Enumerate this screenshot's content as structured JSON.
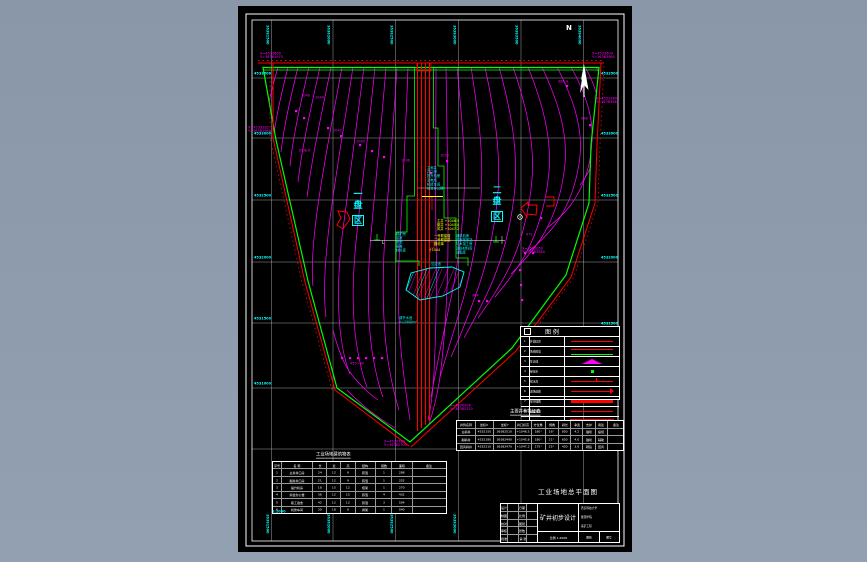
{
  "meta": {
    "description": "CAD mine industrial-site general layout drawing on black model space",
    "colors": {
      "background": "#8e9cae",
      "paper": "#000000",
      "frame": "#ffffff",
      "contour": "#ff00ff",
      "boundary_green": "#00ff00",
      "boundary_red": "#ff0000",
      "annotation_cyan": "#00ffff",
      "annotation_yellow": "#ffff00"
    }
  },
  "frame": {
    "north_letter": "N"
  },
  "grid": {
    "left_row_labels": [
      {
        "x": 254,
        "y": 72,
        "t": "4533500"
      },
      {
        "x": 254,
        "y": 132,
        "t": "4533000"
      },
      {
        "x": 254,
        "y": 194,
        "t": "4532500"
      },
      {
        "x": 254,
        "y": 256,
        "t": "4532000"
      },
      {
        "x": 254,
        "y": 317,
        "t": "4531500"
      },
      {
        "x": 254,
        "y": 382,
        "t": "4531000"
      }
    ],
    "right_row_labels": [
      {
        "x": 601,
        "y": 72,
        "t": "4533500"
      },
      {
        "x": 601,
        "y": 132,
        "t": "4533000"
      },
      {
        "x": 601,
        "y": 194,
        "t": "4532500"
      },
      {
        "x": 601,
        "y": 256,
        "t": "4532000"
      },
      {
        "x": 601,
        "y": 322,
        "t": "4531500"
      },
      {
        "x": 601,
        "y": 382,
        "t": "4531000"
      },
      {
        "x": 601,
        "y": 444,
        "t": "4530500"
      }
    ],
    "top_col_labels": [
      {
        "x": 269,
        "y": 25,
        "t": "36381500",
        "r": 1
      },
      {
        "x": 330,
        "y": 25,
        "t": "36382000",
        "r": 1
      },
      {
        "x": 393,
        "y": 25,
        "t": "36382500",
        "r": 1
      },
      {
        "x": 456,
        "y": 25,
        "t": "36383000",
        "r": 1
      },
      {
        "x": 518,
        "y": 25,
        "t": "36383500",
        "r": 1
      },
      {
        "x": 581,
        "y": 25,
        "t": "36384000",
        "r": 1
      }
    ],
    "bottom_col_labels": [
      {
        "x": 269,
        "y": 514,
        "t": "36381500",
        "r": 1
      },
      {
        "x": 330,
        "y": 514,
        "t": "36382000",
        "r": 1
      },
      {
        "x": 393,
        "y": 514,
        "t": "36382500",
        "r": 1
      },
      {
        "x": 456,
        "y": 514,
        "t": "36383000",
        "r": 1
      }
    ]
  },
  "coord_labels": [
    {
      "x": 248,
      "y": 126,
      "t": "X=4533282",
      "t2": "Y=36381960"
    },
    {
      "x": 260,
      "y": 52,
      "t": "X=4533600",
      "t2": "Y=36381975"
    },
    {
      "x": 592,
      "y": 52,
      "t": "X=4533600",
      "t2": "Y=36383980"
    },
    {
      "x": 596,
      "y": 97,
      "t": "X=4533380",
      "t2": "Y=36383940"
    },
    {
      "x": 450,
      "y": 404,
      "t": "X=4530900",
      "t2": "Y=36383120"
    },
    {
      "x": 384,
      "y": 440,
      "t": "X=4530780",
      "t2": "Y=36382700"
    },
    {
      "x": 522,
      "y": 247,
      "t": "X=4532050",
      "t2": "Y=36383560"
    }
  ],
  "elev_labels": [
    {
      "x": 301,
      "y": 94,
      "t": "1046"
    },
    {
      "x": 315,
      "y": 96,
      "t": "1044"
    },
    {
      "x": 333,
      "y": 129,
      "t": "1042"
    },
    {
      "x": 356,
      "y": 140,
      "t": "1040"
    },
    {
      "x": 558,
      "y": 80,
      "t": "986.4"
    },
    {
      "x": 581,
      "y": 117,
      "t": "988"
    },
    {
      "x": 472,
      "y": 294,
      "t": "964"
    },
    {
      "x": 350,
      "y": 362,
      "t": "455+60"
    },
    {
      "x": 440,
      "y": 154,
      "t": "1038"
    },
    {
      "x": 526,
      "y": 233,
      "t": "972"
    },
    {
      "x": 298,
      "y": 149,
      "t": "1038.6"
    },
    {
      "x": 401,
      "y": 159,
      "t": "1036"
    }
  ],
  "clusters": {
    "top": {
      "x": 427,
      "y": 166,
      "lines": [
        "主斜井",
        "井口房",
        "提升机房",
        "变电所",
        "机修车间",
        "综合办公楼"
      ]
    },
    "left": {
      "x": 396,
      "y": 232,
      "lines": [
        "锅炉房",
        "浴室",
        "食堂",
        "宿舍",
        "材料库"
      ]
    },
    "right": {
      "x": 456,
      "y": 234,
      "lines": [
        "通风机房",
        "瓦斯抽放站",
        "坑木加工房",
        "消防材料库",
        "油脂库"
      ]
    },
    "pond": {
      "x": 399,
      "y": 316,
      "lines": [
        "调节水池",
        "V=2000m³"
      ]
    },
    "pond2": {
      "x": 431,
      "y": 262,
      "lines": [
        "沉淀池"
      ]
    }
  },
  "yellow_notes": {
    "a": {
      "x": 437,
      "y": 219,
      "lines": [
        "主井 +1046.5",
        "副井 +1045.0",
        "风井 +1047.2"
      ]
    },
    "b": {
      "x": 434,
      "y": 234,
      "lines": [
        "一号联建楼",
        "二号联建楼",
        "器材库"
      ]
    },
    "c": {
      "x": 429,
      "y": 248,
      "lines": [
        "+1044"
      ]
    }
  },
  "panels": {
    "left": {
      "chars": [
        "一",
        "盘",
        "区"
      ]
    },
    "right": {
      "chars": [
        "二",
        "盘",
        "区"
      ]
    }
  },
  "legend": {
    "title": "图    例",
    "rows": [
      {
        "n": "1",
        "name": "井田境界",
        "sym": "red-line"
      },
      {
        "n": "2",
        "name": "场地围墙",
        "sym": "red-green"
      },
      {
        "n": "3",
        "name": "等高线",
        "sym": "tent"
      },
      {
        "n": "4",
        "name": "绿化带",
        "sym": "green-dot"
      },
      {
        "n": "5",
        "name": "排水沟",
        "sym": "red-tick"
      },
      {
        "n": "6",
        "name": "进场道路",
        "sym": "red-arrow"
      },
      {
        "n": "7",
        "name": "架空线路",
        "sym": "red-line2"
      },
      {
        "n": "8",
        "name": "运煤通道",
        "sym": "red-line"
      },
      {
        "n": "9",
        "name": "工业广场",
        "sym": "mag-fill"
      },
      {
        "n": "10",
        "name": "其 它",
        "sym": "none"
      }
    ]
  },
  "tables": {
    "left": {
      "title": "工业场地建筑物表",
      "cols": "5 18 8 8 8 12 9 12 20",
      "rows": [
        [
          "序号",
          "名 称",
          "长",
          "宽",
          "高",
          "结构",
          "层数",
          "面积",
          "备注"
        ],
        [
          "1",
          "主井井口房",
          "24",
          "12",
          "9",
          "砖混",
          "1",
          "288",
          ""
        ],
        [
          "2",
          "副井井口房",
          "21",
          "12",
          "9",
          "砖混",
          "1",
          "252",
          ""
        ],
        [
          "3",
          "提升机房",
          "18",
          "15",
          "12",
          "框架",
          "1",
          "270",
          ""
        ],
        [
          "4",
          "综合办公楼",
          "36",
          "12",
          "15",
          "砖混",
          "4",
          "432",
          ""
        ],
        [
          "5",
          "职工宿舍",
          "42",
          "12",
          "12",
          "砖混",
          "3",
          "504",
          ""
        ],
        [
          "6",
          "机修车间",
          "30",
          "18",
          "9",
          "排架",
          "1",
          "540",
          ""
        ]
      ]
    },
    "right": {
      "title": "主要井巷特征表",
      "cols": "12 12 14 10 9 8 8 7 8 8 10",
      "rows": [
        [
          "井筒名称",
          "坐标X",
          "坐标Y",
          "井口标高",
          "方位角",
          "倾角",
          "斜长",
          "净宽",
          "支护",
          "用途",
          "备注"
        ],
        [
          "主斜井",
          "4532150",
          "36382510",
          "+1046.5",
          "180°",
          "16°",
          "850",
          "4.2",
          "锚喷",
          "提煤",
          ""
        ],
        [
          "副斜井",
          "4532180",
          "36382490",
          "+1045.8",
          "180°",
          "21°",
          "650",
          "4.0",
          "锚喷",
          "辅助",
          ""
        ],
        [
          "回风斜井",
          "4532210",
          "36382470",
          "+1047.2",
          "175°",
          "25°",
          "420",
          "3.6",
          "砌碹",
          "回风",
          ""
        ]
      ]
    }
  },
  "title_block": {
    "sig": {
      "cols": "10 16 10 16",
      "rows": [
        [
          "设计",
          "",
          "日期",
          ""
        ],
        [
          "制图",
          "",
          "比例",
          ""
        ],
        [
          "校对",
          "",
          "图别",
          ""
        ],
        [
          "审核",
          "",
          "张数",
          ""
        ],
        [
          "批准",
          "",
          "第 张",
          ""
        ]
      ]
    },
    "main_title": "矿井初步设计",
    "scale_line": "比例 1:2000",
    "right_lines": [
      "西安科技大学",
      "能源学院",
      "采矿工程"
    ],
    "right_bottom": [
      "图别",
      "图号"
    ]
  },
  "titles": {
    "drawing_title": "工业场地总平面图",
    "scale_note": "1:2000"
  }
}
